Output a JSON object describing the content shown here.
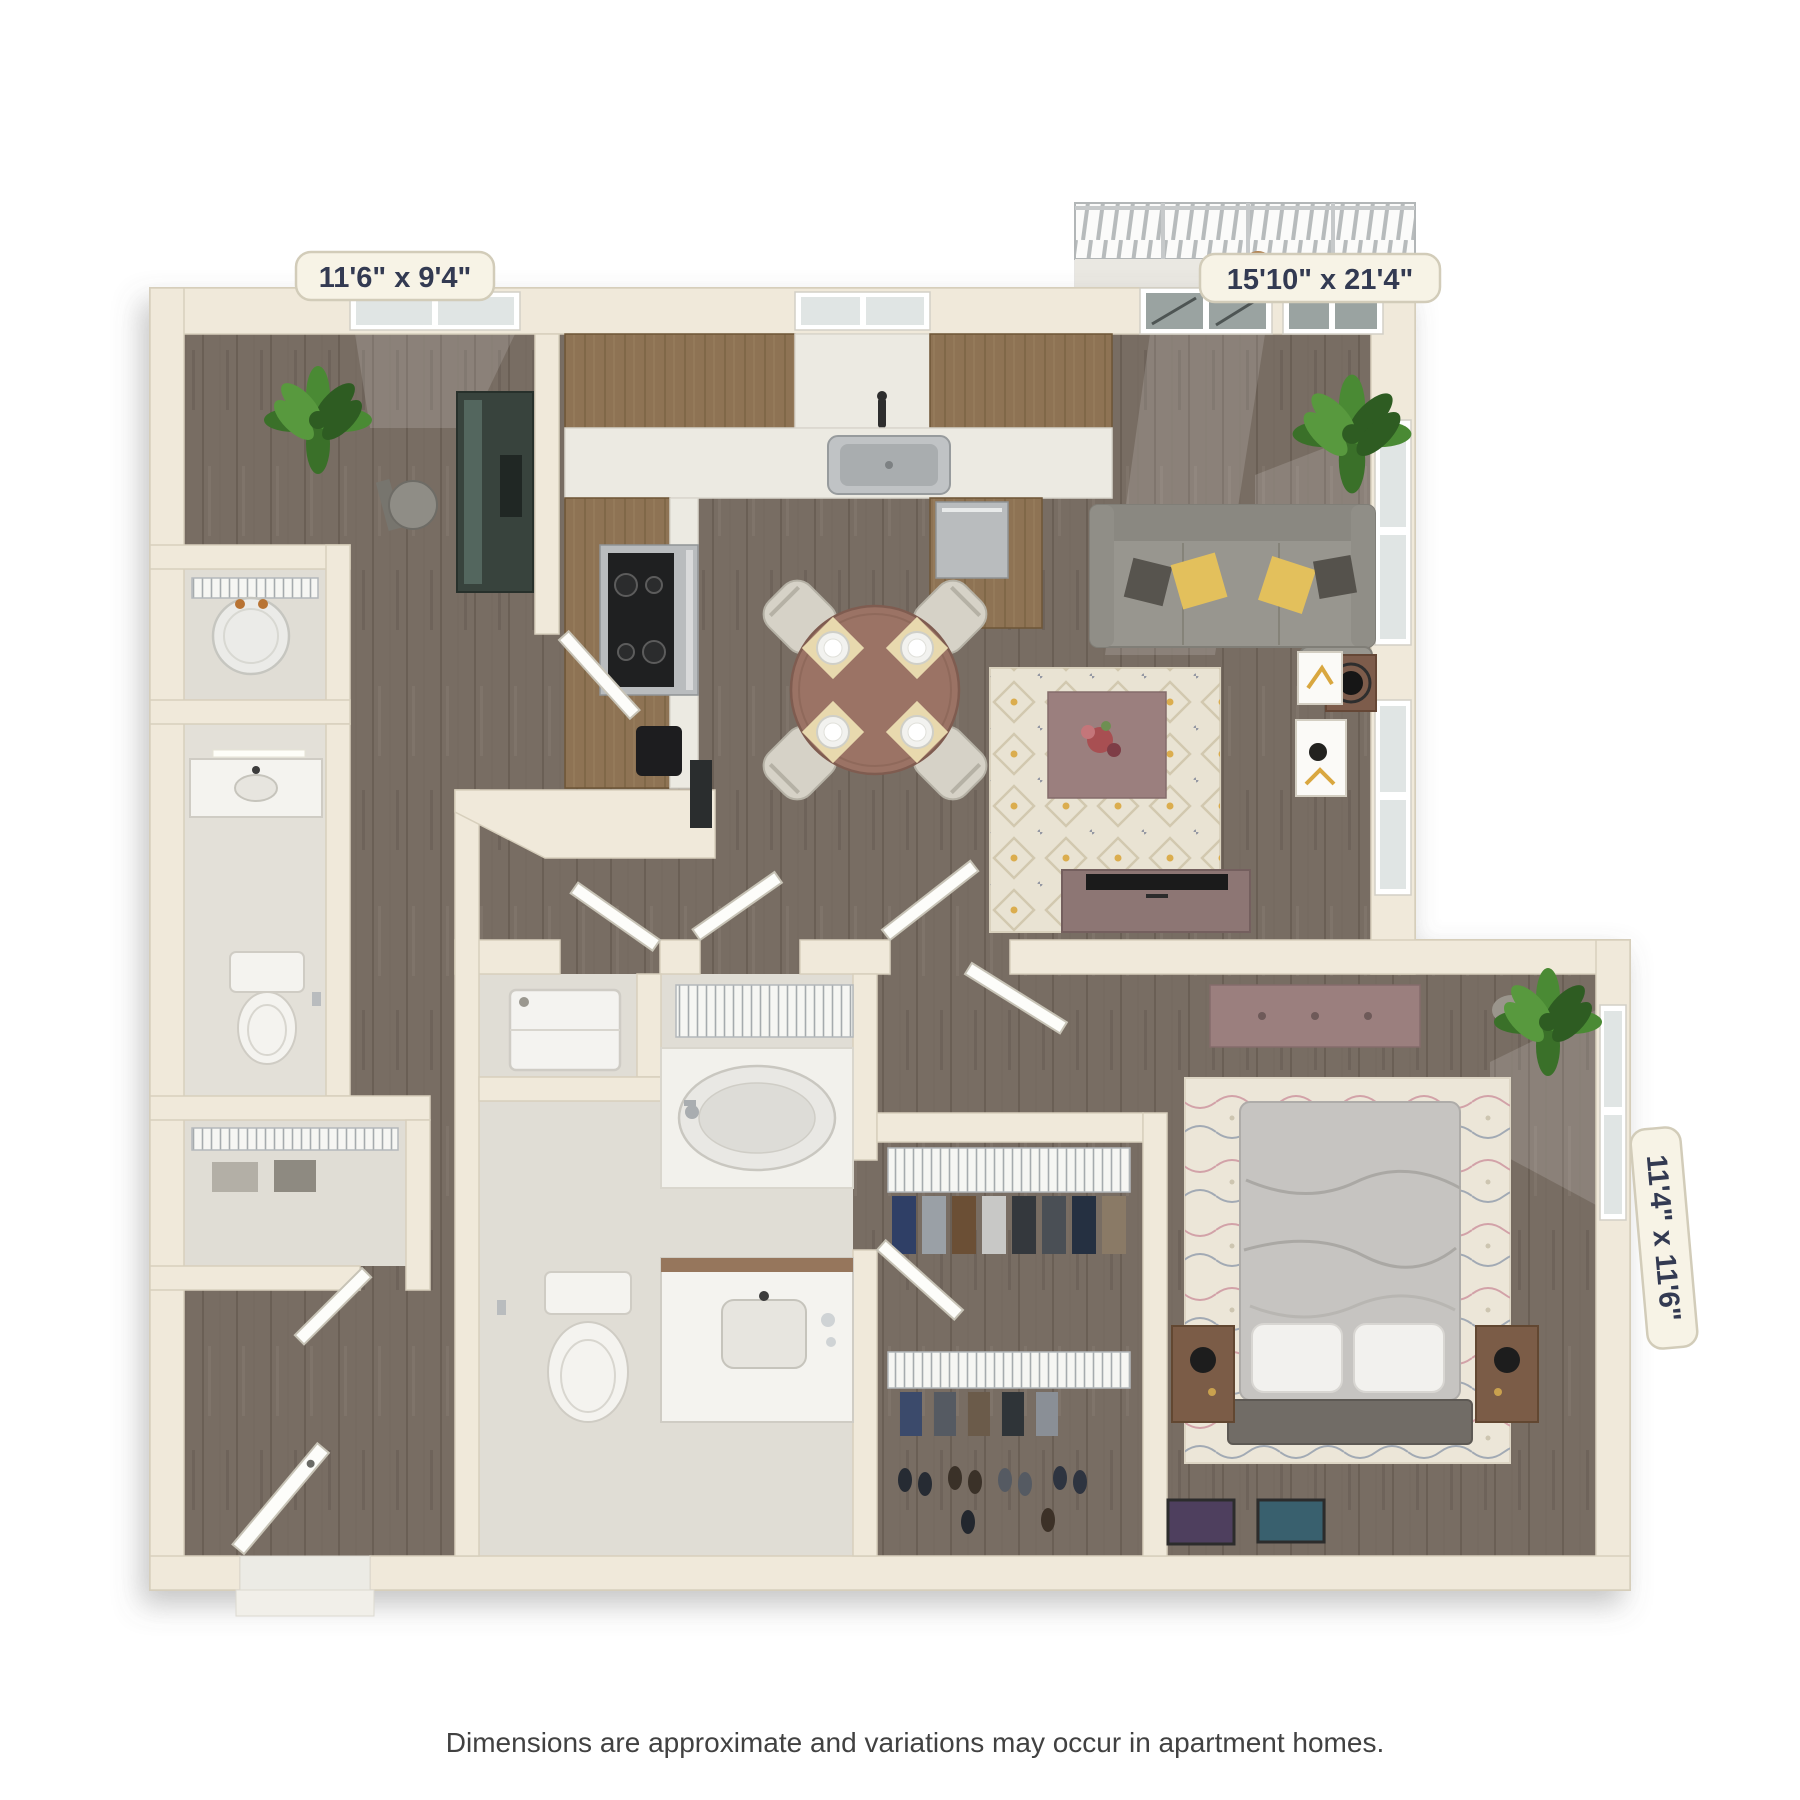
{
  "view": {
    "type": "3d-floor-plan-render",
    "background": "#ffffff"
  },
  "labels": {
    "office_den": "11'6\" x 9'4\"",
    "living_dining": "15'10\" x 21'4\"",
    "bedroom": "11'4\" x 11'6\""
  },
  "disclaimer": "Dimensions are approximate and variations may occur in apartment homes.",
  "rooms": [
    {
      "name": "office-den",
      "dimensions": "11'6\" x 9'4\"",
      "furniture": [
        "desk",
        "office-chair",
        "potted-plant",
        "window"
      ]
    },
    {
      "name": "kitchen",
      "furniture": [
        "u-shaped-counter",
        "upper-cabinets",
        "sink",
        "faucet",
        "range-stove",
        "dishwasher",
        "coffee-maker",
        "window"
      ]
    },
    {
      "name": "dining-area",
      "furniture": [
        "round-table",
        "four-chairs",
        "four-place-settings"
      ]
    },
    {
      "name": "living-room",
      "dimensions": "15'10\" x 21'4\"",
      "furniture": [
        "sofa",
        "throw-pillows",
        "area-rug",
        "coffee-table",
        "flowers",
        "tv-console",
        "tv",
        "side-table",
        "lamp",
        "potted-plant",
        "wall-art",
        "windows",
        "balcony-doors"
      ]
    },
    {
      "name": "balcony",
      "furniture": [
        "railing",
        "planter"
      ]
    },
    {
      "name": "utility-closet",
      "furniture": [
        "water-heater",
        "wire-shelf"
      ]
    },
    {
      "name": "bathroom-2",
      "furniture": [
        "vanity-sink",
        "vanity-light",
        "toilet",
        "paper-holder"
      ]
    },
    {
      "name": "hall-closet",
      "furniture": [
        "wire-shelf",
        "storage-boxes"
      ]
    },
    {
      "name": "entry",
      "furniture": [
        "front-door",
        "threshold"
      ]
    },
    {
      "name": "bathroom-1",
      "furniture": [
        "washer",
        "wire-linen-shelf",
        "bathtub",
        "toilet",
        "vanity-sink"
      ]
    },
    {
      "name": "walk-in-closet",
      "furniture": [
        "wire-shelving",
        "hanging-clothes",
        "shoes"
      ]
    },
    {
      "name": "bedroom",
      "dimensions": "11'4\" x 11'6\"",
      "furniture": [
        "bed",
        "pillows",
        "headboard",
        "nightstands",
        "lamps",
        "dresser",
        "area-rug",
        "potted-plant",
        "window",
        "floor-frames"
      ]
    }
  ],
  "palette": {
    "background": "#ffffff",
    "wall": "#f0e9da",
    "wall_edge": "#d7cfbc",
    "floor_wood": "#786d63",
    "floor_tile": "#e0ddd5",
    "cabinet_wood": "#8e7354",
    "countertop": "#eceae2",
    "sofa_gray": "#98968f",
    "accent_yellow": "#e3c05c",
    "furniture_mauve": "#9b7f7e",
    "rug_cream": "#e9e3d3",
    "plant_green": "#4a8a34",
    "label_text": "#333a52",
    "disclaimer_text": "#414141"
  }
}
